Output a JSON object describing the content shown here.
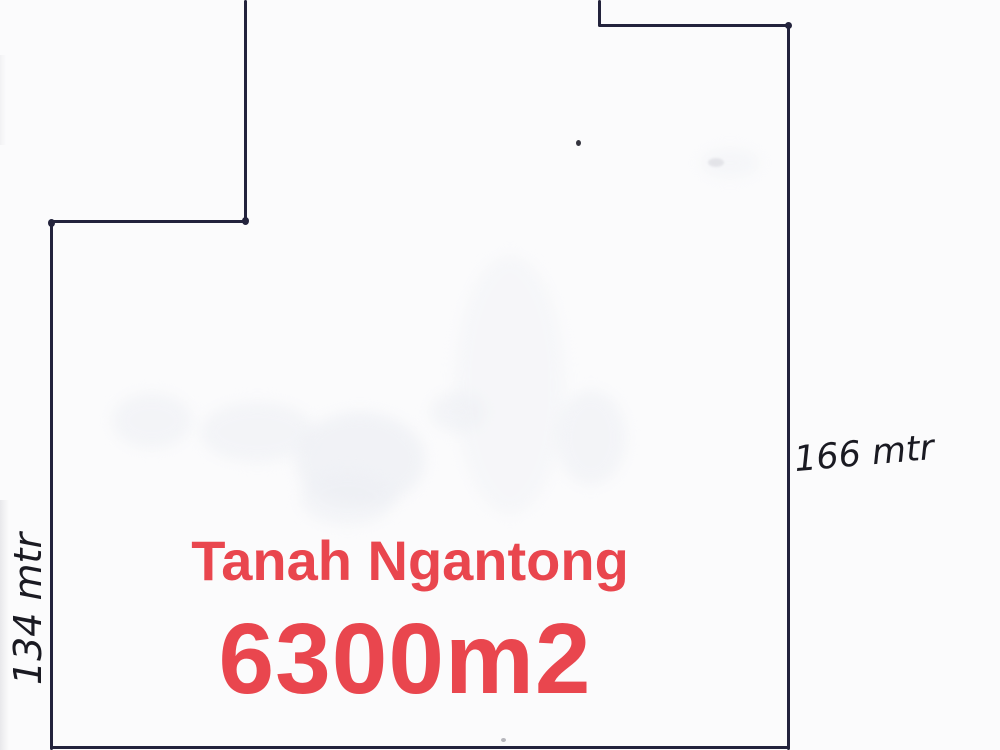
{
  "sketch": {
    "title": "Tanah Ngantong",
    "area": "6300m2",
    "left_dimension": "134 mtr",
    "right_dimension": "166 mtr"
  },
  "colors": {
    "paper_background": "#fbfbfc",
    "ink_outline": "#23233c",
    "handwriting_ink": "#1a1a22",
    "title_red": "#e9464e"
  }
}
